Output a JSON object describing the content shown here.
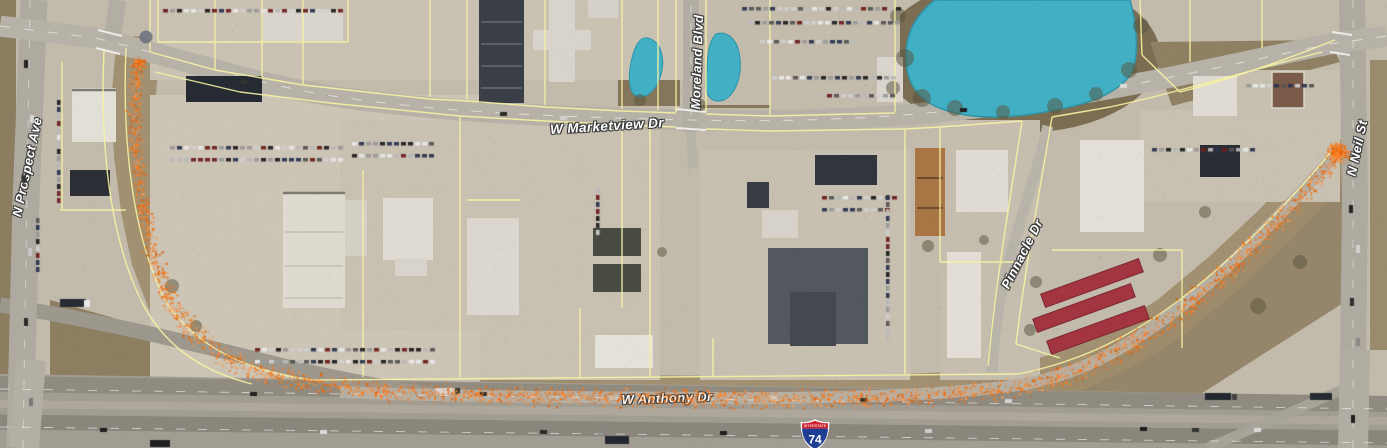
{
  "map": {
    "street_labels": [
      {
        "id": "w-marketview-dr",
        "text": "W Marketview Dr"
      },
      {
        "id": "moreland-blvd",
        "text": "Moreland Blvd"
      },
      {
        "id": "n-prospect-ave",
        "text": "N Prospect Ave"
      },
      {
        "id": "n-neil-st",
        "text": "N Neil St"
      },
      {
        "id": "pinnacle-dr",
        "text": "Pinnacle Dr"
      },
      {
        "id": "w-anthony-dr",
        "text": "W Anthony Dr"
      }
    ],
    "highway_shield": {
      "top_text": "INTERSTATE",
      "number": "74"
    },
    "overlay_trace": {
      "name": "orange-point-trace",
      "palette": [
        "#ff7d1f",
        "#f97316",
        "#fb8c33",
        "#e96a0c",
        "#ff9a4d",
        "#d85f08",
        "#ef6c09"
      ],
      "path": [
        [
          137,
          58
        ],
        [
          133,
          105
        ],
        [
          136,
          155
        ],
        [
          143,
          210
        ],
        [
          153,
          258
        ],
        [
          168,
          298
        ],
        [
          190,
          330
        ],
        [
          222,
          356
        ],
        [
          262,
          372
        ],
        [
          320,
          384
        ],
        [
          400,
          391
        ],
        [
          500,
          395
        ],
        [
          620,
          397
        ],
        [
          740,
          398
        ],
        [
          860,
          398
        ],
        [
          950,
          394
        ],
        [
          1020,
          386
        ],
        [
          1070,
          372
        ],
        [
          1120,
          349
        ],
        [
          1170,
          318
        ],
        [
          1225,
          272
        ],
        [
          1275,
          225
        ],
        [
          1312,
          186
        ],
        [
          1333,
          160
        ]
      ],
      "band_widths": [
        14,
        16,
        16,
        18,
        20,
        22,
        24,
        24,
        22,
        22,
        22,
        22,
        22,
        22,
        22,
        22,
        24,
        26,
        26,
        26,
        26,
        24,
        20,
        16
      ],
      "density": 2.4,
      "clusters": [
        {
          "x": 1337,
          "y": 152,
          "r": 14,
          "n": 380
        },
        {
          "x": 139,
          "y": 62,
          "r": 8,
          "n": 90
        }
      ]
    },
    "water_color": "#41b0c4",
    "parcel_line_color": "#f7f3a2",
    "marker_dot": {
      "x": 146,
      "y": 37
    }
  }
}
